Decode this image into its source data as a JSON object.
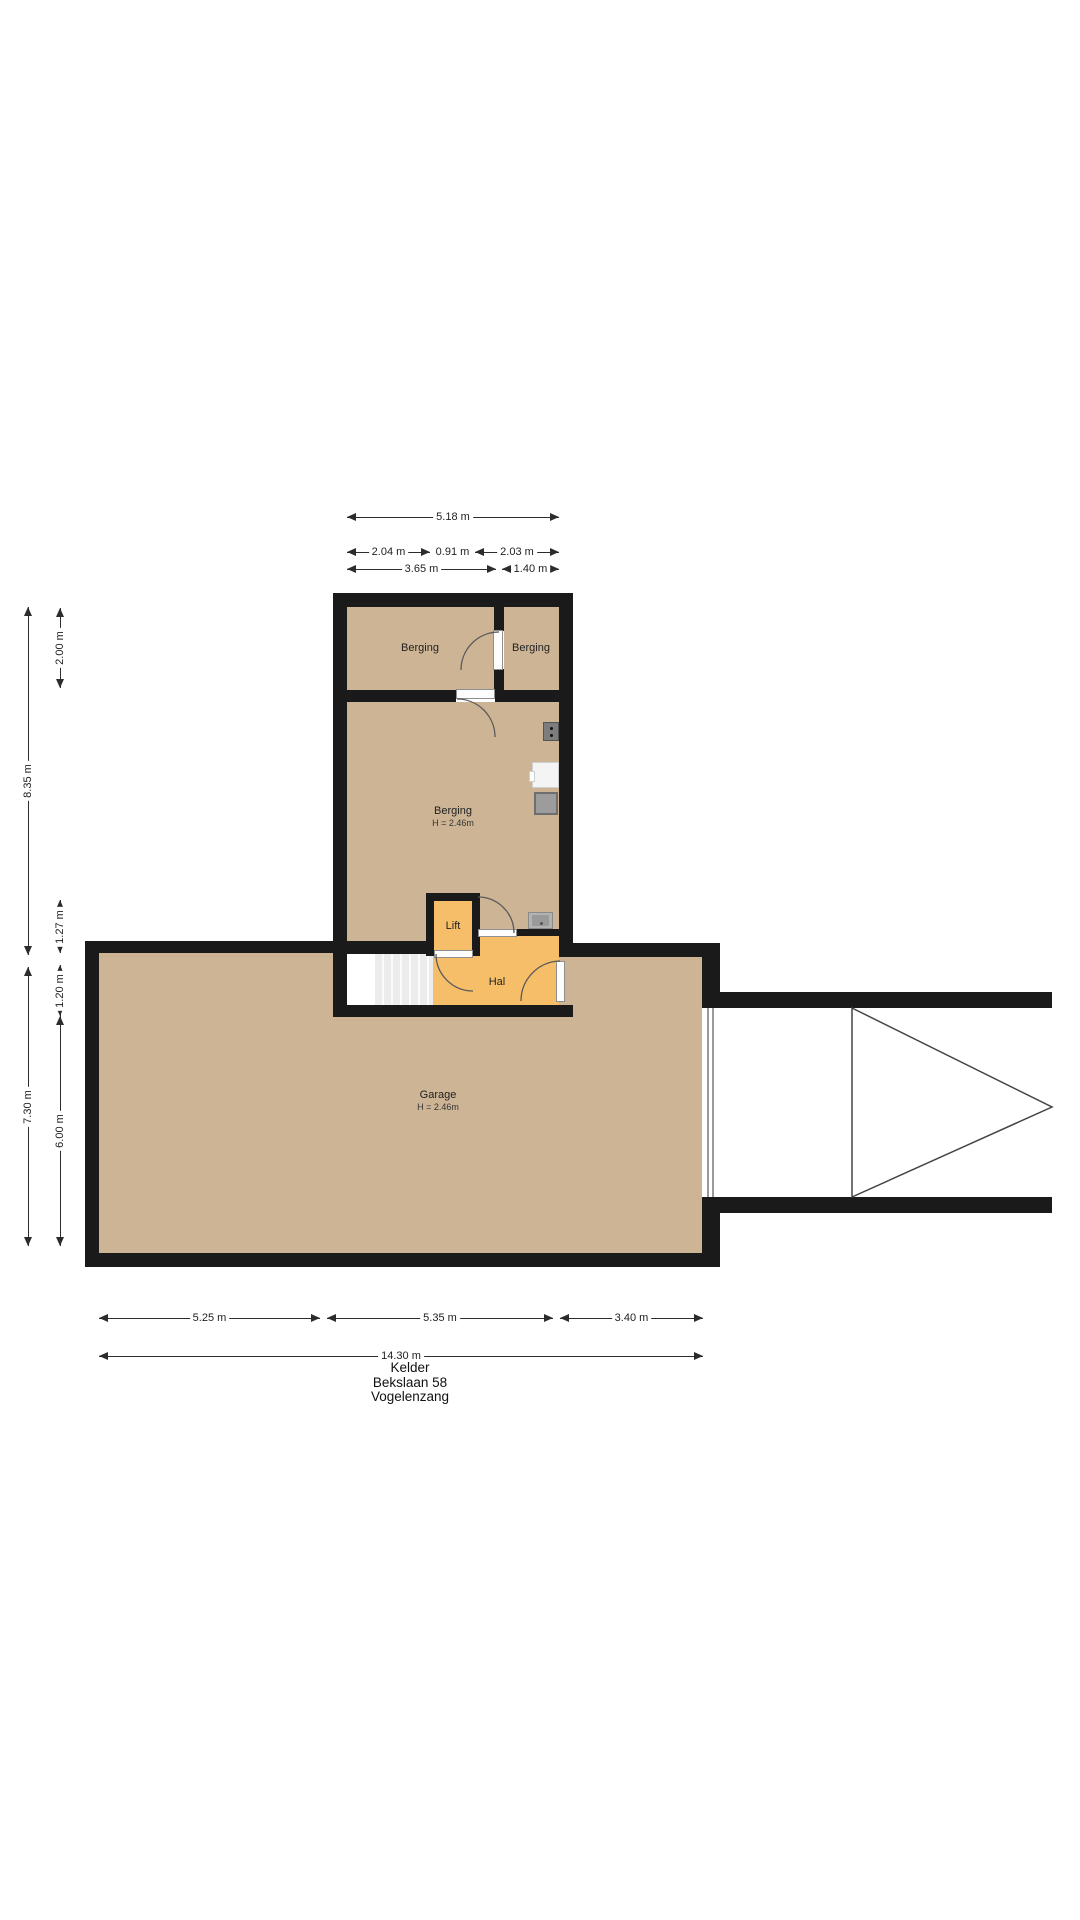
{
  "meta": {
    "floorplan_title": "Kelder",
    "address_line1": "Bekslaan 58",
    "address_line2": "Vogelenzang"
  },
  "rooms": {
    "berging_top_left": {
      "label": "Berging"
    },
    "berging_top_right": {
      "label": "Berging"
    },
    "berging_main": {
      "label": "Berging",
      "ceiling_height": "H = 2.46m"
    },
    "lift": {
      "label": "Lift"
    },
    "hal": {
      "label": "Hal"
    },
    "garage": {
      "label": "Garage",
      "ceiling_height": "H = 2.46m"
    }
  },
  "dimensions": {
    "top": {
      "total_width": "5.18 m",
      "segment_2_04": "2.04 m",
      "segment_0_91": "0.91 m",
      "segment_2_03": "2.03 m",
      "segment_3_65": "3.65 m",
      "segment_1_40": "1.40 m"
    },
    "left": {
      "height_8_35": "8.35 m",
      "height_2_00": "2.00 m",
      "height_1_27": "1.27 m",
      "height_1_20": "1.20 m",
      "height_7_30": "7.30 m",
      "height_6_00": "6.00 m"
    },
    "bottom": {
      "segment_5_25": "5.25 m",
      "segment_5_35": "5.35 m",
      "segment_3_40": "3.40 m",
      "total_width": "14.30 m"
    }
  },
  "colors": {
    "room_fill": "#CDB495",
    "hall_fill": "#F7BE69",
    "wall": "#1A1A1A",
    "background": "#FFFFFF",
    "driveway_outline": "#444444"
  }
}
